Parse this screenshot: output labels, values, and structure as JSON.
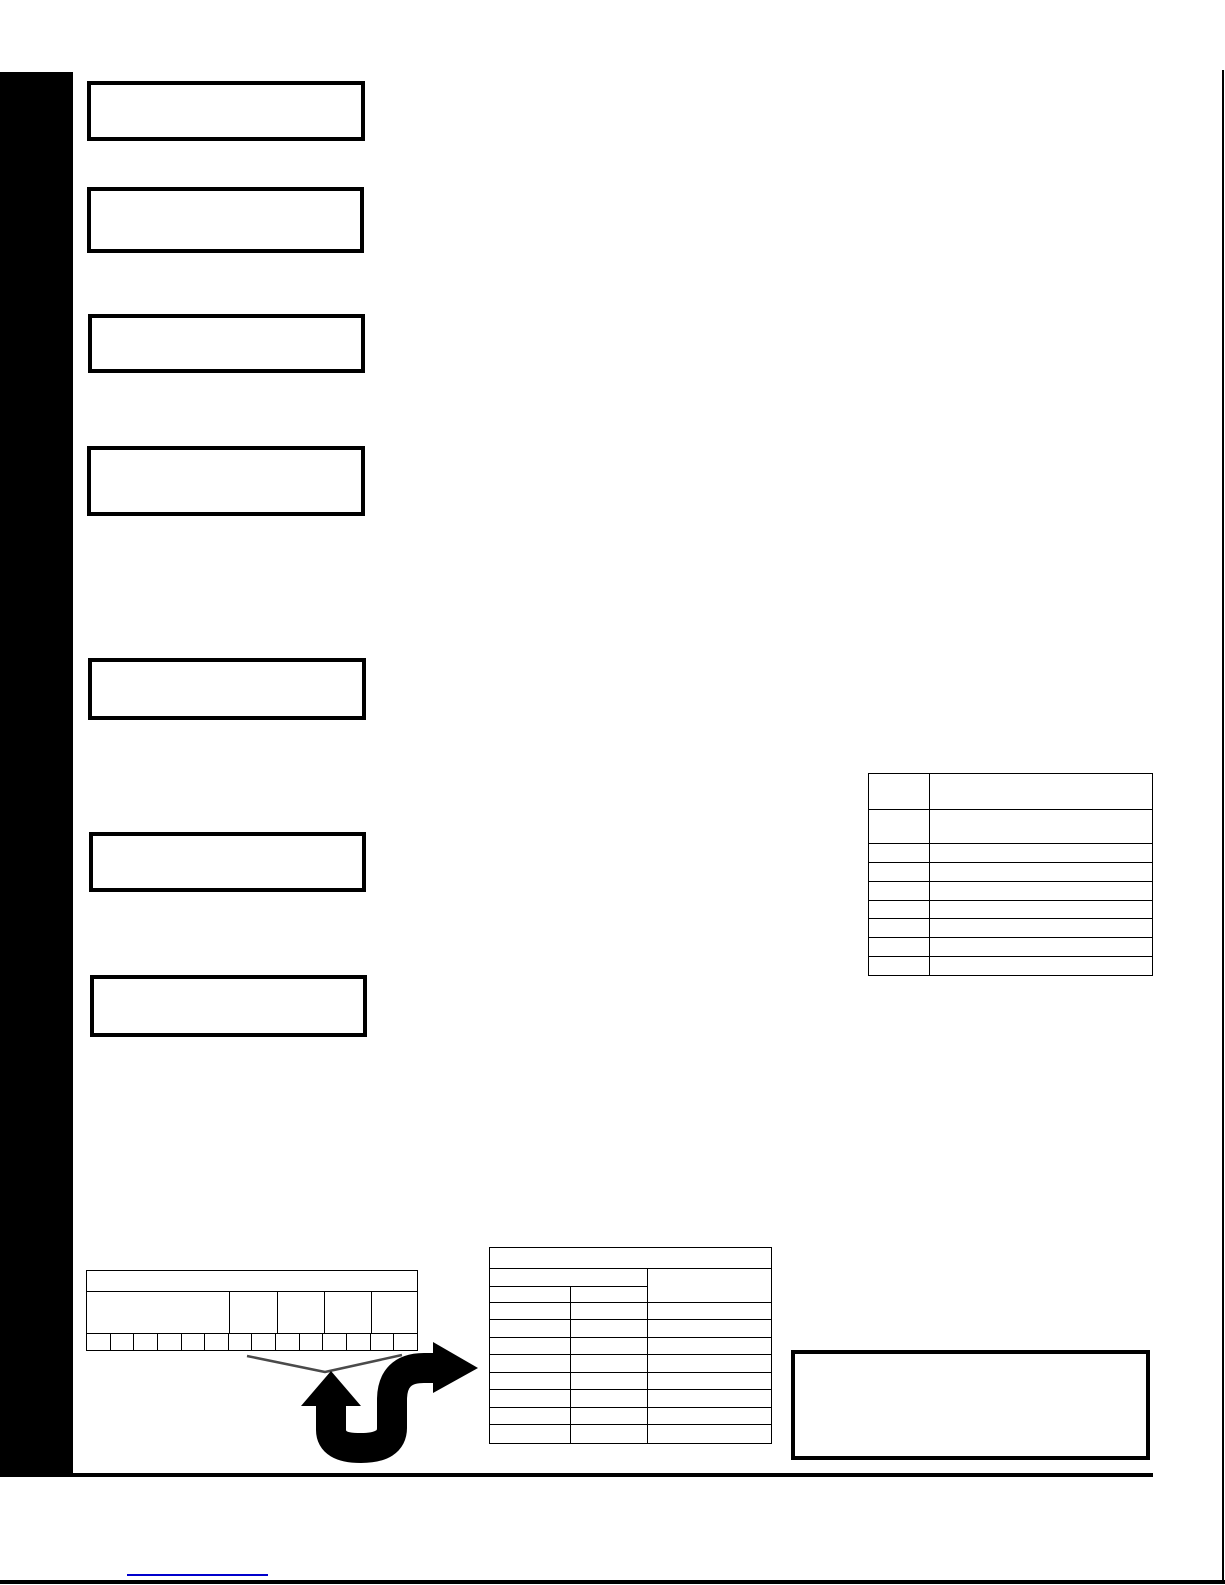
{
  "page": {
    "background_color": "#ffffff",
    "ink_color": "#000000"
  },
  "sidebar_tab": {
    "color": "#000000"
  },
  "callout_boxes": [
    {
      "label": ""
    },
    {
      "label": ""
    },
    {
      "label": ""
    },
    {
      "label": ""
    },
    {
      "label": ""
    },
    {
      "label": ""
    },
    {
      "label": ""
    }
  ],
  "spec_table": {
    "rows": [
      [
        "",
        ""
      ],
      [
        "",
        ""
      ],
      [
        "",
        ""
      ],
      [
        "",
        ""
      ],
      [
        "",
        ""
      ],
      [
        "",
        ""
      ],
      [
        "",
        ""
      ],
      [
        "",
        ""
      ],
      [
        "",
        ""
      ]
    ]
  },
  "strip_table": {
    "header_label": "",
    "group_cells": [
      "",
      "",
      "",
      "",
      ""
    ],
    "unit_cells": [
      "",
      "",
      "",
      "",
      "",
      "",
      "",
      "",
      "",
      "",
      "",
      "",
      "",
      ""
    ]
  },
  "pointer_table": {
    "title_label": "",
    "subgroup_span_label": "",
    "subgroup_columns": [
      "",
      ""
    ],
    "result_column_label": "",
    "data_rows": [
      [
        "",
        "",
        ""
      ],
      [
        "",
        "",
        ""
      ],
      [
        "",
        "",
        ""
      ],
      [
        "",
        "",
        ""
      ],
      [
        "",
        "",
        ""
      ],
      [
        "",
        "",
        ""
      ],
      [
        "",
        "",
        ""
      ],
      [
        "",
        "",
        ""
      ]
    ]
  },
  "note_box": {
    "text": ""
  },
  "graphics": {
    "s_arrow_color": "#000000",
    "brace_color": "#4a4a4a"
  },
  "footer": {
    "link_label": "",
    "link_color": "#0000cc"
  }
}
